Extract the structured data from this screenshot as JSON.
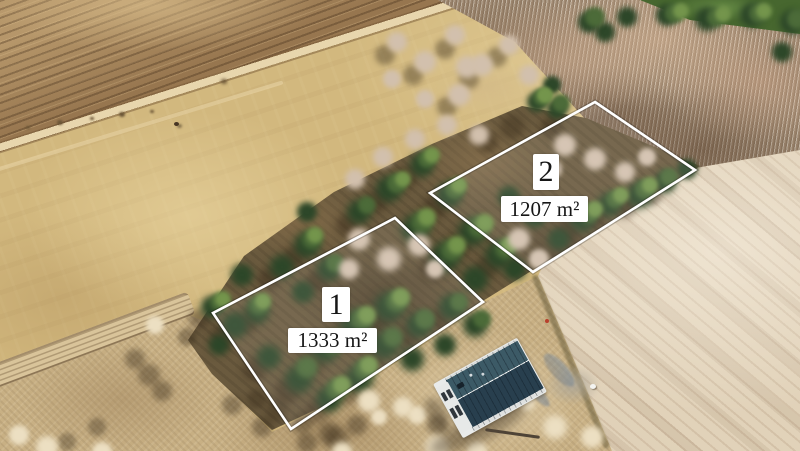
{
  "overlay": {
    "plots": [
      {
        "number": "1",
        "area": "1333 m²"
      },
      {
        "number": "2",
        "area": "1207 m²"
      }
    ]
  },
  "colors": {
    "plot_outline": "#ffffff",
    "plot_fill": "rgba(255,255,255,0.09)",
    "label_background": "#ffffff",
    "label_text": "#161616",
    "house_roof": "#2b4150",
    "house_walls": "#e9ebea",
    "meadow": "#d2b87e",
    "tilled_field": "#e1d2b9",
    "plowed_band": "#97764f",
    "forest_green": "#2d4729",
    "birch": "#d2c0ad",
    "sand": "#c8b084",
    "track": "#e8d6ad"
  }
}
